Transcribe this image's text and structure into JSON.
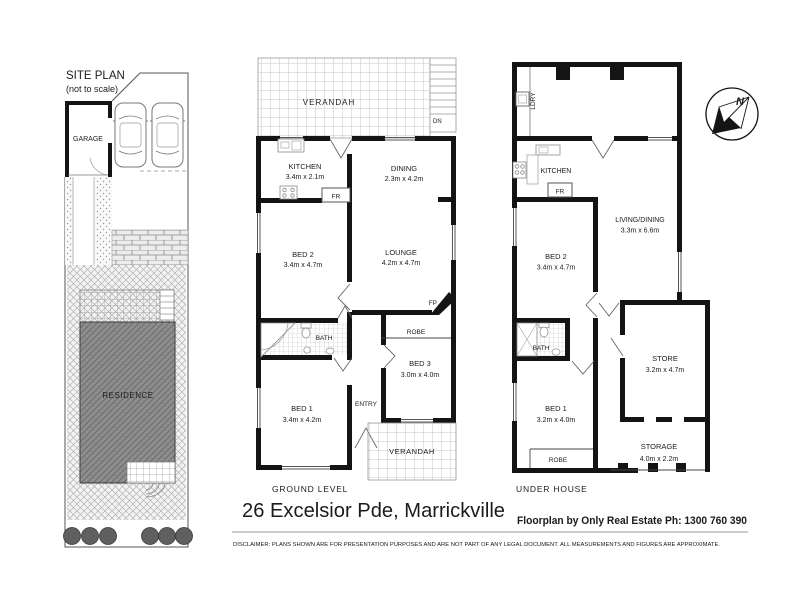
{
  "address_title": "26 Excelsior Pde, Marrickville",
  "credit": "Floorplan by Only Real Estate Ph: 1300 760 390",
  "disclaimer": "DISCLAIMER:  PLANS SHOWN ARE FOR PRESENTATION PURPOSES AND ARE NOT PART OF ANY LEGAL DOCUMENT. ALL MEASUREMENTS AND FIGURES ARE APPROXIMATE.",
  "site_plan": {
    "title": "SITE PLAN",
    "subtitle": "(not to scale)",
    "garage": "GARAGE",
    "residence": "RESIDENCE"
  },
  "ground_level": {
    "caption": "GROUND LEVEL",
    "verandah_top": "VERANDAH",
    "verandah_bottom": "VERANDAH",
    "kitchen": {
      "name": "KITCHEN",
      "dims": "3.4m x 2.1m"
    },
    "dining": {
      "name": "DINING",
      "dims": "2.3m x 4.2m"
    },
    "lounge": {
      "name": "LOUNGE",
      "dims": "4.2m x 4.7m"
    },
    "bed2": {
      "name": "BED 2",
      "dims": "3.4m x 4.7m"
    },
    "bed1": {
      "name": "BED 1",
      "dims": "3.4m x 4.2m"
    },
    "bed3": {
      "name": "BED 3",
      "dims": "3.0m x 4.0m"
    },
    "bath": "BATH",
    "robe": "ROBE",
    "entry": "ENTRY",
    "fridge": "FR",
    "fireplace": "FP",
    "stairs_down": "DN"
  },
  "under_house": {
    "caption": "UNDER HOUSE",
    "laundry": "LDRY",
    "kitchen": "KITCHEN",
    "fridge": "FR",
    "living_dining": {
      "name": "LIVING/DINING",
      "dims": "3.3m x 6.6m"
    },
    "bed2": {
      "name": "BED 2",
      "dims": "3.4m x 4.7m"
    },
    "bed1": {
      "name": "BED 1",
      "dims": "3.2m x 4.0m"
    },
    "bath": "BATH",
    "robe": "ROBE",
    "store": {
      "name": "STORE",
      "dims": "3.2m x 4.7m"
    },
    "storage": {
      "name": "STORAGE",
      "dims": "4.0m x 2.2m"
    }
  },
  "compass": {
    "north": "N"
  },
  "colors": {
    "wall": "#141414",
    "line": "#8a8a8a",
    "residence_fill": "#8f8f8f"
  }
}
